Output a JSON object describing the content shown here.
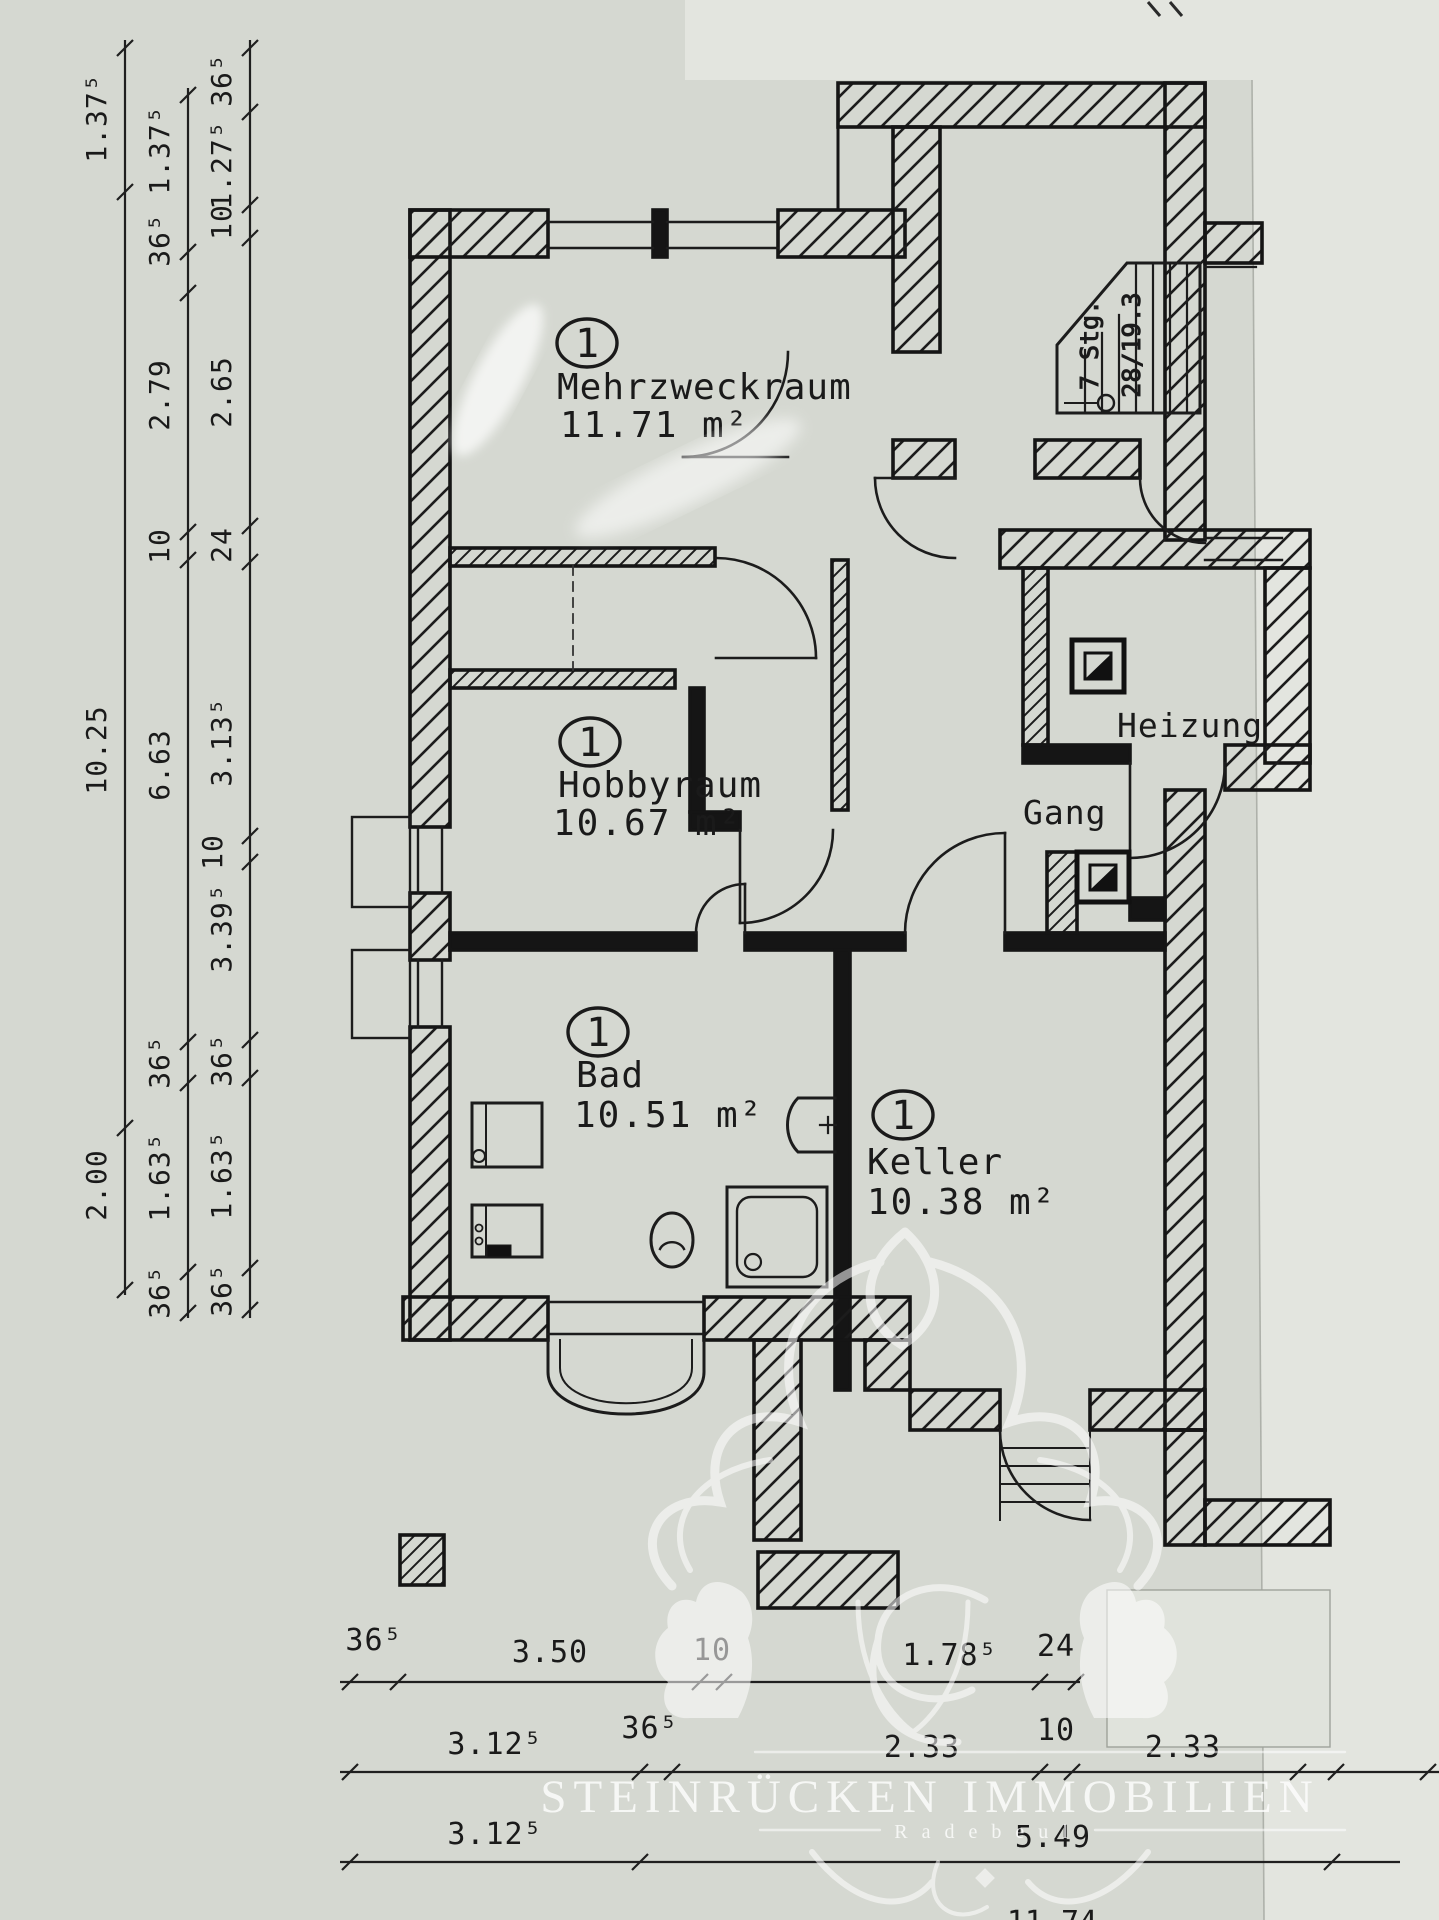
{
  "photo": {
    "paper_color": "#d5d8d1",
    "light_sheet_color": "#e3e5df",
    "ink_color": "#161616"
  },
  "plan": {
    "rooms": [
      {
        "unit": "1",
        "name": "Mehrzweckraum",
        "area": "11.71 m²"
      },
      {
        "unit": "1",
        "name": "Hobbyraum",
        "area": "10.67 m²"
      },
      {
        "unit": "1",
        "name": "Bad",
        "area": "10.51 m²"
      },
      {
        "unit": "1",
        "name": "Keller",
        "area": "10.38 m²"
      },
      {
        "name": "Heizung"
      },
      {
        "name": "Gang"
      }
    ],
    "stairs": {
      "line1": "7 Stg.",
      "line2": "28/19.3"
    }
  },
  "dims": {
    "left_outer": [
      "1.37⁵",
      "10.25",
      "2.00"
    ],
    "left_middle": [
      "1.37⁵",
      "36⁵",
      "2.79",
      "10",
      "6.63",
      "36⁵",
      "1.63⁵",
      "36⁵"
    ],
    "left_inner": [
      "36⁵",
      "1.27⁵",
      "10",
      "2.65",
      "24",
      "3.13⁵",
      "10",
      "3.39⁵",
      "36⁵",
      "1.63⁵",
      "36⁵"
    ],
    "bottom_row1": [
      "36⁵",
      "3.50",
      "10",
      "1.78⁵",
      "24"
    ],
    "bottom_row2": [
      "3.12⁵",
      "36⁵",
      "2.33",
      "10",
      "2.33"
    ],
    "bottom_row3": [
      "3.12⁵",
      "5.49"
    ],
    "partial_bottom": "11.74"
  },
  "watermark": {
    "company": "STEINRÜCKEN IMMOBILIEN",
    "city": "Radebeul"
  }
}
